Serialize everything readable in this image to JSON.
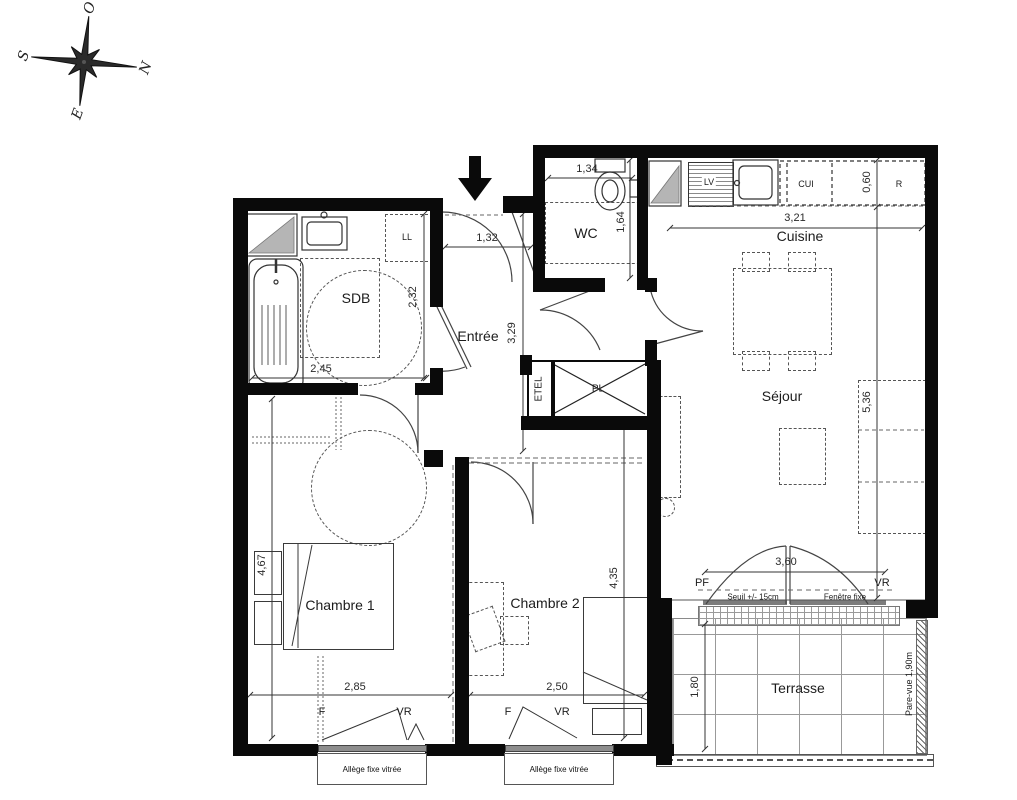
{
  "compass": {
    "n": "N",
    "s": "S",
    "e": "E",
    "o": "O"
  },
  "rooms": {
    "wc": {
      "name": "WC",
      "dim_width": "1,34",
      "dim_height": "1,64"
    },
    "cuisine": {
      "name": "Cuisine",
      "dim_width": "3,21",
      "dim_depth": "0,60",
      "lv": "LV",
      "cui": "CUI",
      "r": "R"
    },
    "sdb": {
      "name": "SDB",
      "dim_width": "2,45",
      "dim_height": "2,32",
      "ll": "LL"
    },
    "entree": {
      "name": "Entrée",
      "dim_width": "1,32",
      "dim_height": "3,29"
    },
    "pl": {
      "name": "PL"
    },
    "etel": {
      "name": "ETEL"
    },
    "sejour": {
      "name": "Séjour",
      "dim_height": "5,36",
      "dim_bay": "3,60",
      "pf": "PF",
      "vr": "VR",
      "seuil": "Seuil +/- 15cm",
      "fenetre_fixe": "Fenêtre fixe"
    },
    "chambre1": {
      "name": "Chambre 1",
      "dim_height": "4,67",
      "dim_width": "2,85",
      "f": "F",
      "vr": "VR",
      "allege": "Allège fixe vitrée"
    },
    "chambre2": {
      "name": "Chambre 2",
      "dim_height": "4,35",
      "dim_width": "2,50",
      "f": "F",
      "vr": "VR",
      "allege": "Allège fixe vitrée"
    },
    "terrasse": {
      "name": "Terrasse",
      "dim_depth": "1,80",
      "pare_vue": "Pare-vue 1,90m"
    }
  }
}
